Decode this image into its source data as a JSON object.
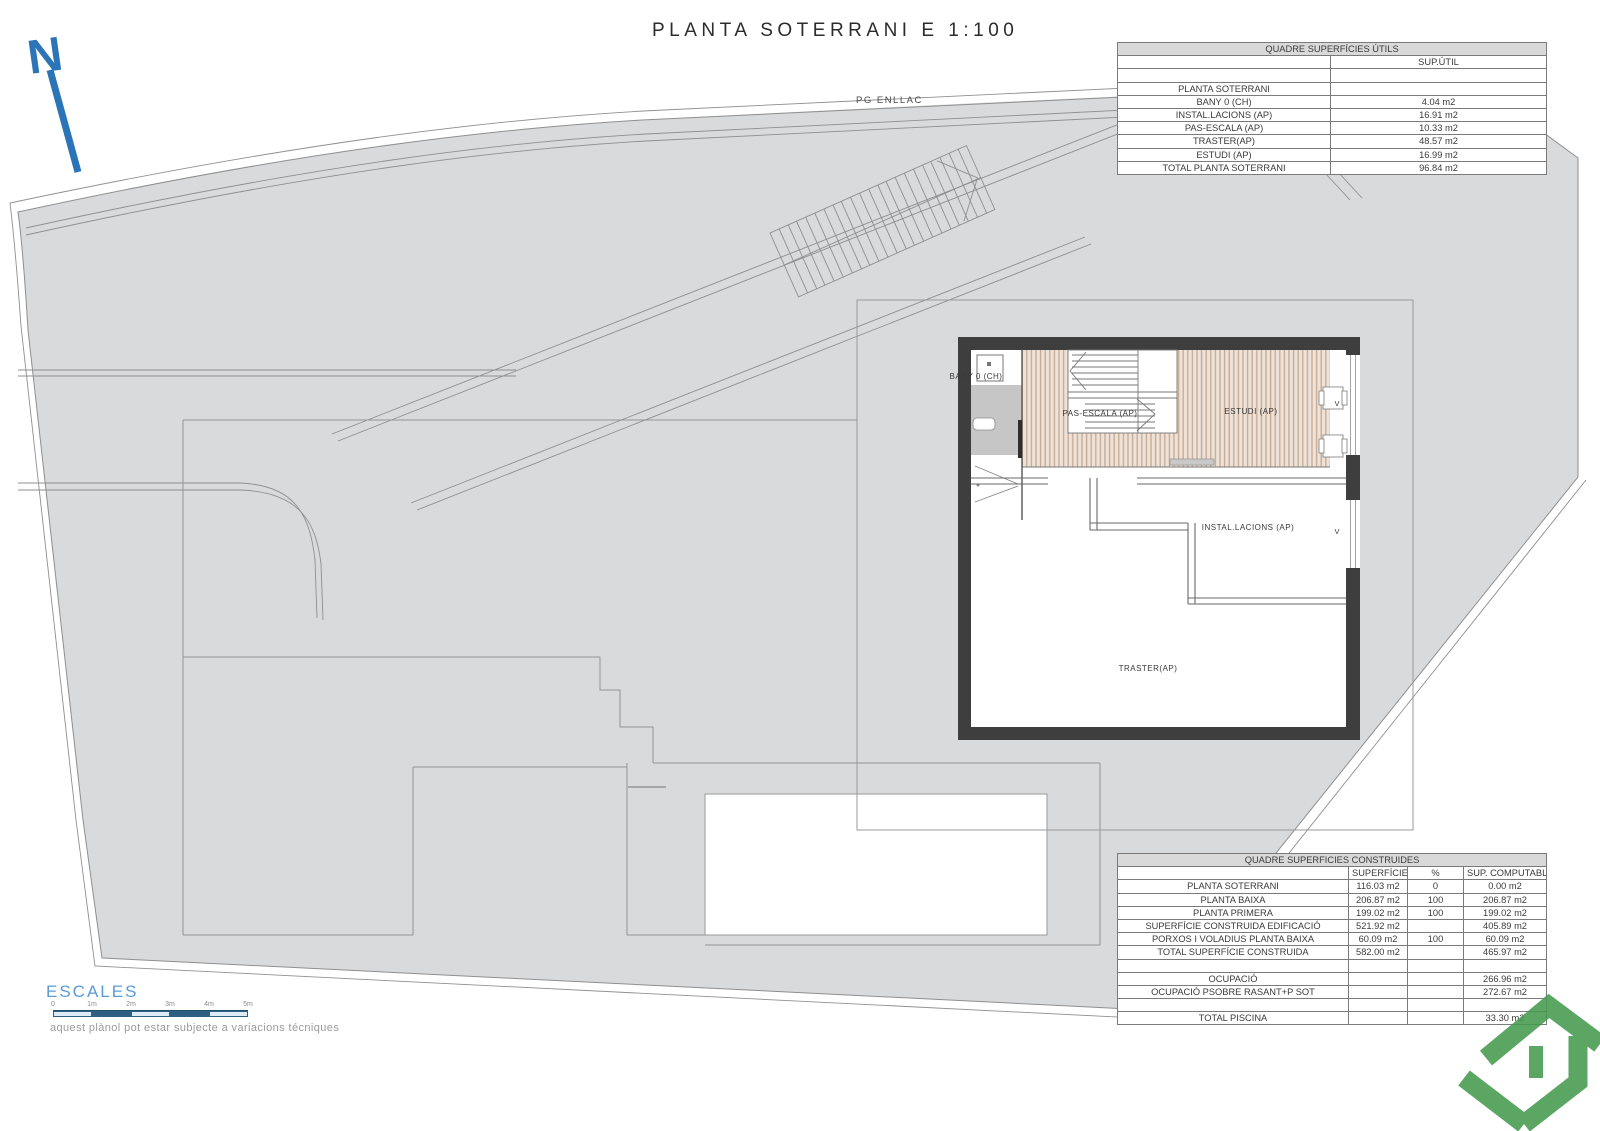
{
  "title": "PLANTA SOTERRANI E 1:100",
  "pg_enllac": "PG ENLLAC",
  "north_label": "N",
  "plan": {
    "labels": {
      "bany": "BANY 0 (CH)",
      "pas_escala": "PAS-ESCALA (AP)",
      "estudi": "ESTUDI (AP)",
      "installacions": "INSTAL.LACIONS (AP)",
      "traster": "TRASTER(AP)",
      "window": "V"
    }
  },
  "table_utils": {
    "title": "QUADRE SUPERFÍCIES ÚTILS",
    "rows": [
      [
        "",
        "SUP.ÚTIL"
      ],
      [
        "",
        ""
      ],
      [
        "PLANTA SOTERRANI",
        ""
      ],
      [
        "BANY 0 (CH)",
        "4.04 m2"
      ],
      [
        "INSTAL.LACIONS (AP)",
        "16.91 m2"
      ],
      [
        "PAS-ESCALA (AP)",
        "10.33 m2"
      ],
      [
        "TRASTER(AP)",
        "48.57 m2"
      ],
      [
        "ESTUDI (AP)",
        "16.99 m2"
      ],
      [
        "TOTAL PLANTA SOTERRANI",
        "96.84 m2"
      ]
    ]
  },
  "table_construides": {
    "title": "QUADRE SUPERFICIES CONSTRUIDES",
    "rows": [
      [
        "",
        "SUPERFÍCIE",
        "%",
        "SUP. COMPUTABLE"
      ],
      [
        "PLANTA SOTERRANI",
        "116.03 m2",
        "0",
        "0.00 m2"
      ],
      [
        "PLANTA BAIXA",
        "206.87 m2",
        "100",
        "206.87 m2"
      ],
      [
        "PLANTA PRIMERA",
        "199.02 m2",
        "100",
        "199.02 m2"
      ],
      [
        "SUPERFÍCIE CONSTRUIDA EDIFICACIÓ",
        "521.92 m2",
        "",
        "405.89 m2"
      ],
      [
        "PORXOS I VOLADIUS PLANTA BAIXA",
        "60.09 m2",
        "100",
        "60.09 m2"
      ],
      [
        "TOTAL SUPERFÍCIE CONSTRUIDA",
        "582.00 m2",
        "",
        "465.97 m2"
      ],
      [
        "",
        "",
        "",
        ""
      ],
      [
        "OCUPACIÓ",
        "",
        "",
        "266.96 m2"
      ],
      [
        "OCUPACIÓ PSOBRE RASANT+P SOT",
        "",
        "",
        "272.67 m2"
      ],
      [
        "",
        "",
        "",
        ""
      ],
      [
        "TOTAL PISCINA",
        "",
        "",
        "33.30 m2"
      ]
    ]
  },
  "scale_bar": {
    "label": "ESCALES",
    "ticks": [
      "0",
      "1m",
      "2m",
      "3m",
      "4m",
      "5m"
    ]
  },
  "disclaimer": "aquest plànol pot estar subjecte a variacions técniques",
  "colors": {
    "terrain": "#d9dadb",
    "wall": "#3e3e3e",
    "wood_floor": "#eee3d8",
    "wood_stripe": "#c9ab97",
    "accent_blue": "#2b74b8",
    "scale_light": "#dcebf5",
    "scale_dark": "#2e6083",
    "logo_green": "#459a4d",
    "line": "#8f8f8f"
  }
}
